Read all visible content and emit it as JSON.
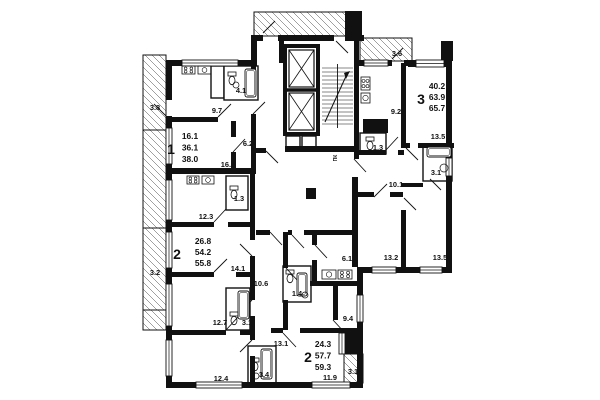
{
  "background": "#ffffff",
  "ink": "#111111",
  "apartments": [
    {
      "number": "1",
      "stats": [
        "16.1",
        "36.1",
        "38.0"
      ],
      "num_x": 171,
      "num_y": 154,
      "sx": 190,
      "sy": 139,
      "lh": 11.5
    },
    {
      "number": "2",
      "stats": [
        "26.8",
        "54.2",
        "55.8"
      ],
      "num_x": 177,
      "num_y": 259,
      "sx": 203,
      "sy": 244,
      "lh": 11
    },
    {
      "number": "3",
      "stats": [
        "40.2",
        "63.9",
        "65.7"
      ],
      "num_x": 421,
      "num_y": 104,
      "sx": 437,
      "sy": 89,
      "lh": 11
    },
    {
      "number": "2",
      "stats": [
        "24.3",
        "57.7",
        "59.3"
      ],
      "num_x": 308,
      "num_y": 362,
      "sx": 323,
      "sy": 347,
      "lh": 11.5
    }
  ],
  "room_labels": [
    {
      "t": "3.8",
      "x": 155,
      "y": 110
    },
    {
      "t": "9.7",
      "x": 217,
      "y": 113
    },
    {
      "t": "4.1",
      "x": 241,
      "y": 93
    },
    {
      "t": "6.2",
      "x": 248,
      "y": 146
    },
    {
      "t": "16.1",
      "x": 228,
      "y": 167
    },
    {
      "t": "3.6",
      "x": 397,
      "y": 56
    },
    {
      "t": "9.2",
      "x": 396,
      "y": 114
    },
    {
      "t": "13.5",
      "x": 438,
      "y": 139
    },
    {
      "t": "1.3",
      "x": 378,
      "y": 150
    },
    {
      "t": "3.1",
      "x": 436,
      "y": 175
    },
    {
      "t": "10.1",
      "x": 396,
      "y": 187
    },
    {
      "t": "1.3",
      "x": 239,
      "y": 201
    },
    {
      "t": "12.3",
      "x": 206,
      "y": 219
    },
    {
      "t": "3.2",
      "x": 155,
      "y": 275
    },
    {
      "t": "14.1",
      "x": 238,
      "y": 271
    },
    {
      "t": "10.6",
      "x": 261,
      "y": 286
    },
    {
      "t": "6.1",
      "x": 347,
      "y": 261
    },
    {
      "t": "13.2",
      "x": 391,
      "y": 260
    },
    {
      "t": "13.5",
      "x": 440,
      "y": 260
    },
    {
      "t": "1.4",
      "x": 297,
      "y": 296
    },
    {
      "t": "9.4",
      "x": 348,
      "y": 321
    },
    {
      "t": "12.7",
      "x": 220,
      "y": 325
    },
    {
      "t": "3.1",
      "x": 247,
      "y": 325
    },
    {
      "t": "13.1",
      "x": 281,
      "y": 346
    },
    {
      "t": "12.4",
      "x": 221,
      "y": 381
    },
    {
      "t": "3.4",
      "x": 264,
      "y": 377
    },
    {
      "t": "11.9",
      "x": 330,
      "y": 380
    },
    {
      "t": "3.1",
      "x": 353,
      "y": 374
    }
  ],
  "tiny_labels": [
    {
      "t": "ПК",
      "x": 337,
      "y": 158,
      "rot": -90
    }
  ],
  "plan": {
    "walls": [
      [
        166,
        60,
        6,
        40
      ],
      [
        166,
        116,
        6,
        12
      ],
      [
        166,
        164,
        6,
        16
      ],
      [
        166,
        220,
        6,
        12
      ],
      [
        166,
        268,
        6,
        16
      ],
      [
        166,
        326,
        6,
        14
      ],
      [
        166,
        376,
        6,
        12
      ],
      [
        166,
        60,
        16,
        6
      ],
      [
        238,
        60,
        14,
        6
      ],
      [
        251,
        35,
        6,
        31
      ],
      [
        251,
        35,
        12,
        6
      ],
      [
        278,
        35,
        56,
        6
      ],
      [
        348,
        35,
        16,
        6
      ],
      [
        345,
        11,
        17,
        30
      ],
      [
        358,
        60,
        6,
        6
      ],
      [
        388,
        60,
        4,
        6
      ],
      [
        404,
        60,
        6,
        6
      ],
      [
        408,
        60,
        8,
        7
      ],
      [
        444,
        60,
        8,
        7
      ],
      [
        441,
        41,
        12,
        20
      ],
      [
        446,
        45,
        6,
        113
      ],
      [
        446,
        176,
        6,
        97
      ],
      [
        360,
        267,
        12,
        6
      ],
      [
        396,
        267,
        24,
        6
      ],
      [
        442,
        267,
        10,
        6
      ],
      [
        357,
        267,
        6,
        28
      ],
      [
        357,
        322,
        6,
        66
      ],
      [
        166,
        382,
        30,
        6
      ],
      [
        242,
        382,
        70,
        6
      ],
      [
        350,
        382,
        13,
        6
      ],
      [
        166,
        117,
        52,
        5
      ],
      [
        231,
        121,
        5,
        16
      ],
      [
        231,
        152,
        5,
        16
      ],
      [
        251,
        66,
        5,
        30
      ],
      [
        251,
        114,
        5,
        54
      ],
      [
        166,
        168,
        90,
        6
      ],
      [
        166,
        222,
        48,
        5
      ],
      [
        228,
        222,
        24,
        5
      ],
      [
        166,
        272,
        48,
        5
      ],
      [
        236,
        272,
        16,
        5
      ],
      [
        166,
        330,
        60,
        5
      ],
      [
        240,
        330,
        12,
        5
      ],
      [
        250,
        168,
        5,
        64
      ],
      [
        250,
        232,
        5,
        8
      ],
      [
        250,
        256,
        5,
        44
      ],
      [
        250,
        316,
        5,
        24
      ],
      [
        250,
        356,
        5,
        26
      ],
      [
        256,
        230,
        14,
        5
      ],
      [
        288,
        230,
        4,
        5
      ],
      [
        304,
        230,
        52,
        5
      ],
      [
        283,
        232,
        5,
        36
      ],
      [
        283,
        300,
        5,
        30
      ],
      [
        312,
        235,
        5,
        10
      ],
      [
        312,
        260,
        5,
        24
      ],
      [
        310,
        281,
        50,
        5
      ],
      [
        333,
        286,
        5,
        34
      ],
      [
        271,
        328,
        12,
        5
      ],
      [
        300,
        328,
        57,
        5
      ],
      [
        345,
        333,
        17,
        21
      ],
      [
        401,
        63,
        5,
        85
      ],
      [
        406,
        143,
        4,
        5
      ],
      [
        418,
        143,
        36,
        5
      ],
      [
        358,
        150,
        28,
        5
      ],
      [
        398,
        150,
        6,
        5
      ],
      [
        358,
        192,
        16,
        5
      ],
      [
        390,
        192,
        13,
        5
      ],
      [
        401,
        210,
        5,
        57
      ],
      [
        401,
        183,
        22,
        4
      ],
      [
        354,
        41,
        5,
        118
      ],
      [
        352,
        177,
        6,
        90
      ],
      [
        285,
        146,
        70,
        6
      ],
      [
        256,
        148,
        10,
        5
      ],
      [
        279,
        41,
        5,
        22
      ]
    ],
    "black_blocks": [
      [
        363,
        119,
        25,
        14
      ],
      [
        306,
        188,
        10,
        11
      ]
    ],
    "thin_boxes": [
      [
        211,
        66,
        13,
        32
      ],
      [
        224,
        66,
        34,
        34
      ],
      [
        226,
        176,
        22,
        34
      ],
      [
        226,
        288,
        24,
        42
      ],
      [
        248,
        346,
        28,
        38
      ],
      [
        283,
        266,
        28,
        36
      ],
      [
        360,
        133,
        26,
        21
      ],
      [
        423,
        145,
        29,
        36
      ],
      [
        286,
        136,
        14,
        14
      ],
      [
        302,
        136,
        14,
        14
      ]
    ],
    "windows": [
      [
        182,
        60,
        56,
        6
      ],
      [
        166,
        128,
        6,
        36
      ],
      [
        166,
        180,
        6,
        40
      ],
      [
        166,
        232,
        6,
        36
      ],
      [
        166,
        284,
        6,
        42
      ],
      [
        166,
        340,
        6,
        36
      ],
      [
        196,
        382,
        46,
        6
      ],
      [
        312,
        382,
        38,
        6
      ],
      [
        339,
        333,
        6,
        21
      ],
      [
        357,
        295,
        6,
        27
      ],
      [
        372,
        267,
        24,
        6
      ],
      [
        420,
        267,
        22,
        6
      ],
      [
        446,
        158,
        6,
        18
      ],
      [
        416,
        60,
        28,
        7
      ],
      [
        364,
        60,
        24,
        6
      ]
    ],
    "doors": [
      [
        218,
        117,
        231,
        104
      ],
      [
        233,
        152,
        245,
        139
      ],
      [
        253,
        114,
        265,
        102
      ],
      [
        214,
        222,
        226,
        209
      ],
      [
        214,
        272,
        227,
        259
      ],
      [
        226,
        330,
        238,
        317
      ],
      [
        270,
        232,
        282,
        245
      ],
      [
        292,
        235,
        304,
        248
      ],
      [
        315,
        245,
        327,
        258
      ],
      [
        286,
        268,
        298,
        281
      ],
      [
        283,
        333,
        296,
        347
      ],
      [
        333,
        320,
        345,
        333
      ],
      [
        386,
        150,
        398,
        137
      ],
      [
        374,
        197,
        387,
        184
      ],
      [
        404,
        198,
        416,
        210
      ],
      [
        430,
        179,
        441,
        190
      ],
      [
        354,
        159,
        366,
        172
      ],
      [
        263,
        33,
        275,
        21
      ],
      [
        336,
        41,
        348,
        53
      ],
      [
        392,
        59,
        403,
        48
      ],
      [
        166,
        116,
        154,
        104
      ],
      [
        252,
        256,
        240,
        244
      ],
      [
        252,
        300,
        240,
        312
      ],
      [
        252,
        340,
        240,
        352
      ],
      [
        406,
        148,
        418,
        160
      ],
      [
        266,
        151,
        278,
        163
      ]
    ],
    "balconies": [
      [
        143,
        55,
        23,
        75
      ],
      [
        143,
        130,
        23,
        98
      ],
      [
        143,
        228,
        23,
        82
      ],
      [
        143,
        310,
        23,
        20
      ],
      [
        254,
        12,
        92,
        24
      ],
      [
        360,
        38,
        52,
        23
      ],
      [
        344,
        354,
        19,
        29
      ]
    ],
    "elevator": {
      "x": 285,
      "y": 46,
      "w": 33,
      "h": 88,
      "split": 90
    },
    "stair": {
      "x": 321,
      "y": 64,
      "w": 33,
      "h": 64
    },
    "fixtures": {
      "stoves": [
        [
          182,
          66,
          13,
          8
        ],
        [
          187,
          176,
          12,
          8
        ],
        [
          361,
          77,
          9,
          13
        ],
        [
          338,
          270,
          14,
          9
        ]
      ],
      "sinks": [
        [
          198,
          66,
          13,
          8
        ],
        [
          202,
          176,
          12,
          8
        ],
        [
          361,
          93,
          9,
          10
        ],
        [
          322,
          270,
          14,
          9
        ]
      ],
      "tubs": [
        [
          245,
          69,
          11,
          28
        ],
        [
          427,
          147,
          24,
          10
        ],
        [
          238,
          291,
          11,
          28
        ],
        [
          261,
          349,
          11,
          30
        ],
        [
          297,
          273,
          10,
          23
        ]
      ],
      "toilets": [
        [
          228,
          72
        ],
        [
          230,
          186
        ],
        [
          366,
          137
        ],
        [
          286,
          270
        ],
        [
          251,
          358
        ],
        [
          230,
          312
        ]
      ],
      "circles": [
        [
          444,
          168,
          4
        ],
        [
          256,
          376,
          3
        ],
        [
          305,
          295,
          3
        ],
        [
          236,
          85,
          3
        ]
      ]
    }
  }
}
